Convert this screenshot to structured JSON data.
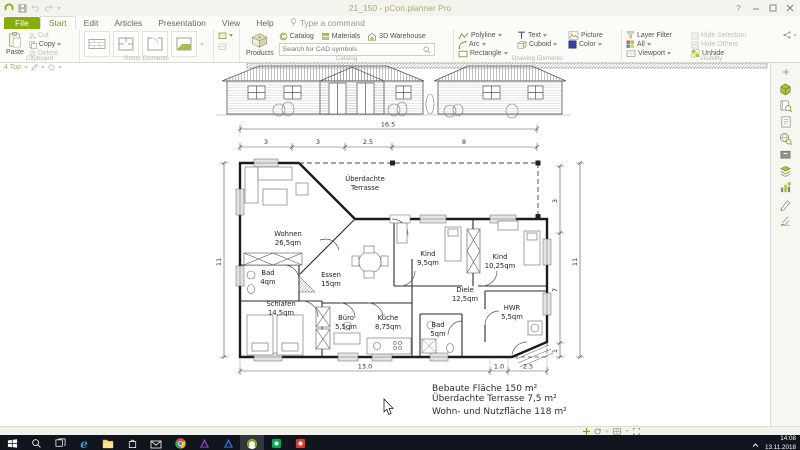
{
  "window": {
    "title": "21_150 - pCon.planner Pro"
  },
  "icons": {
    "help": "?",
    "edge": "e"
  },
  "menu": {
    "file": "File",
    "tabs": [
      "Start",
      "Edit",
      "Articles",
      "Presentation",
      "View",
      "Help"
    ],
    "command": "Type a command"
  },
  "ribbon": {
    "clipboard": {
      "group": "Clipboard",
      "paste": "Paste",
      "cut": "Cut",
      "copy": "Copy",
      "delete": "Delete"
    },
    "room_elements": {
      "group": "Room Elements"
    },
    "catalog": {
      "group": "Catalog",
      "products": "Products",
      "links": [
        "Catalog",
        "Materials",
        "3D Warehouse"
      ],
      "search_placeholder": "Search for CAD symbols"
    },
    "drawing": {
      "group": "Drawing Elements",
      "items": [
        "Polyline",
        "Arc",
        "Rectangle",
        "Text",
        "Cuboid",
        "Picture",
        "Color"
      ]
    },
    "visibility": {
      "group": "Visibility",
      "layer_filter": "Layer Filter",
      "all": "All",
      "viewport": "Viewport",
      "unhide": "Unhide",
      "hide_selection": "Hide Selection",
      "hide_others": "Hide Others"
    }
  },
  "canvas": {
    "viewport_label": "4 Top",
    "terrace": {
      "line1": "Überdachte",
      "line2": "Terrasse"
    },
    "rooms": [
      {
        "name": "Wohnen",
        "area": "26,5qm"
      },
      {
        "name": "Bad",
        "area": "4qm"
      },
      {
        "name": "Essen",
        "area": "15qm"
      },
      {
        "name": "Schlafen",
        "area": "14,5qm"
      },
      {
        "name": "Büro",
        "area": "5,5qm"
      },
      {
        "name": "Küche",
        "area": "8,75qm"
      },
      {
        "name": "Kind",
        "area": "9,5qm"
      },
      {
        "name": "Kind",
        "area": "10,25qm"
      },
      {
        "name": "Diele",
        "area": "12,5qm"
      },
      {
        "name": "HWR",
        "area": "5,5qm"
      },
      {
        "name": "Bad",
        "area": "5qm"
      }
    ],
    "dims": {
      "overall_w": "16.5",
      "top": [
        "3",
        "3",
        "2.5",
        "8"
      ],
      "left": "11",
      "right": [
        "3",
        "7",
        "1"
      ],
      "right_overall": "11",
      "bottom": [
        "13.0",
        "1.0",
        "2.5"
      ]
    },
    "summary": {
      "line1": "Bebaute Fläche 150 m²",
      "line2": "Überdachte Terrasse 7,5 m²",
      "line3": "Wohn- und Nutzfläche 118 m²"
    }
  },
  "taskbar": {
    "time": "14:08",
    "date": "13.11.2018"
  }
}
